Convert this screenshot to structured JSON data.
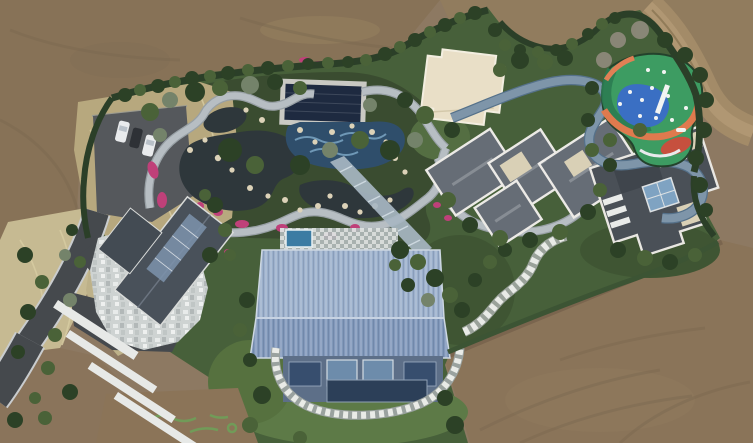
{
  "meta": {
    "title": "Aerial drone photograph of a landscaped private estate surrounded by graded bare earth",
    "view": "top-down aerial"
  },
  "palette": {
    "dirt": "#8d7962",
    "dirtDark": "#7c6a53",
    "dirtLight": "#97825f",
    "dirtRoad": "#a38b68",
    "estate": "#47603a",
    "gardenBed": "#3a4c30",
    "lawn": "#5d7a47",
    "hedge": "#2b3f28",
    "dryGrass": "#b7a87e",
    "dryGrassLight": "#c6ba92",
    "asphalt": "#45494d",
    "parking": "#55585c",
    "carWhite": "#e9ebed",
    "carDark": "#2e3136",
    "pathLight": "#b7bec3",
    "pathBlue": "#7e95a9",
    "pondWater": "#2e373b",
    "poolNavy": "#1e2a40",
    "poolStone": "#c9c9c3",
    "poolMosaic": "#2f4e6b",
    "mosaicLight": "#7ba6c4",
    "flowerPink": "#bf4079",
    "rock": "#dcd2b8",
    "pavilion": "#e9dfc7",
    "playGreen": "#3d9c62",
    "playTeal": "#2b7c52",
    "playBlue": "#3a6fc3",
    "playOrange": "#df7a4e",
    "playRed": "#c6503e",
    "playWhite": "#f2f4f2",
    "barnRoofUpper": "#9db1cd",
    "barnRoofLower": "#8299bb",
    "barnFacade": "#5d6f88",
    "barnWindow": "#2c3f58",
    "terracePool": "#3c7ca3",
    "grayRoof": "#666d76",
    "darkRoof": "#4a5057",
    "parapet": "#eceae6",
    "creamPad": "#d9d0b6",
    "skylight": "#7fa3c2",
    "gableRoof": "#49515a",
    "walkway": "#e7e9e7"
  },
  "scene": {
    "description": "Aerial view of an estate with ornamental gardens, ponds, winding stone paths, a playground and several modern buildings, surrounded by bare graded earth and dirt tracks",
    "elements": [
      {
        "name": "surrounding-bare-earth",
        "label": "Graded bare earth surrounding the estate"
      },
      {
        "name": "perimeter-dirt-road",
        "label": "Dirt track curving along the north-east boundary"
      },
      {
        "name": "access-road",
        "label": "Asphalt access road at the south-west corner"
      },
      {
        "name": "parking-area",
        "label": "Asphalt parking pad with three parked cars"
      },
      {
        "name": "cars",
        "label": "Two white cars flanking one dark car"
      },
      {
        "name": "dry-grass",
        "label": "Dry grass and reed beds near the entrance"
      },
      {
        "name": "boundary-hedge",
        "label": "Clipped evergreen boundary hedges"
      },
      {
        "name": "garden-pond",
        "label": "Dark koi ponds edged with boulders"
      },
      {
        "name": "flower-beds",
        "label": "Magenta azalea flower beds"
      },
      {
        "name": "stone-paths",
        "label": "Winding light-grey stone garden paths"
      },
      {
        "name": "covered-pool",
        "label": "Rectangular pool with dark navy cover and stone surround"
      },
      {
        "name": "mosaic-water-feature",
        "label": "Blue mosaic water feature with rocks"
      },
      {
        "name": "glass-corridor",
        "label": "Glazed corridor linking the garden to the main hall"
      },
      {
        "name": "flat-roof-pavilion",
        "label": "Cream flat-roofed pavilion"
      },
      {
        "name": "playground",
        "label": "Playground with green, blue and orange rubber surfacing"
      },
      {
        "name": "main-hall",
        "label": "Barn-style hall with pale-blue standing-seam metal roof and glazed south facade"
      },
      {
        "name": "roof-terrace",
        "label": "Paved terrace with small plunge pool north of the main hall"
      },
      {
        "name": "stone-patio-house",
        "label": "House with dark glazed gable roof and mottled stone patio"
      },
      {
        "name": "white-walkways",
        "label": "White terraced walkways stepping down the slope"
      },
      {
        "name": "hipped-roof-villa",
        "label": "Villa with interlocking grey hipped roofs and cream decks"
      },
      {
        "name": "flat-roof-villa",
        "label": "Villa with dark flat roof, white parapets and central skylight"
      },
      {
        "name": "stair-path",
        "label": "Chequered stone stair path climbing through shrubs"
      },
      {
        "name": "lawn",
        "label": "Open lawn around the main hall"
      },
      {
        "name": "trees",
        "label": "Evergreen shrubs and specimen trees"
      }
    ]
  }
}
